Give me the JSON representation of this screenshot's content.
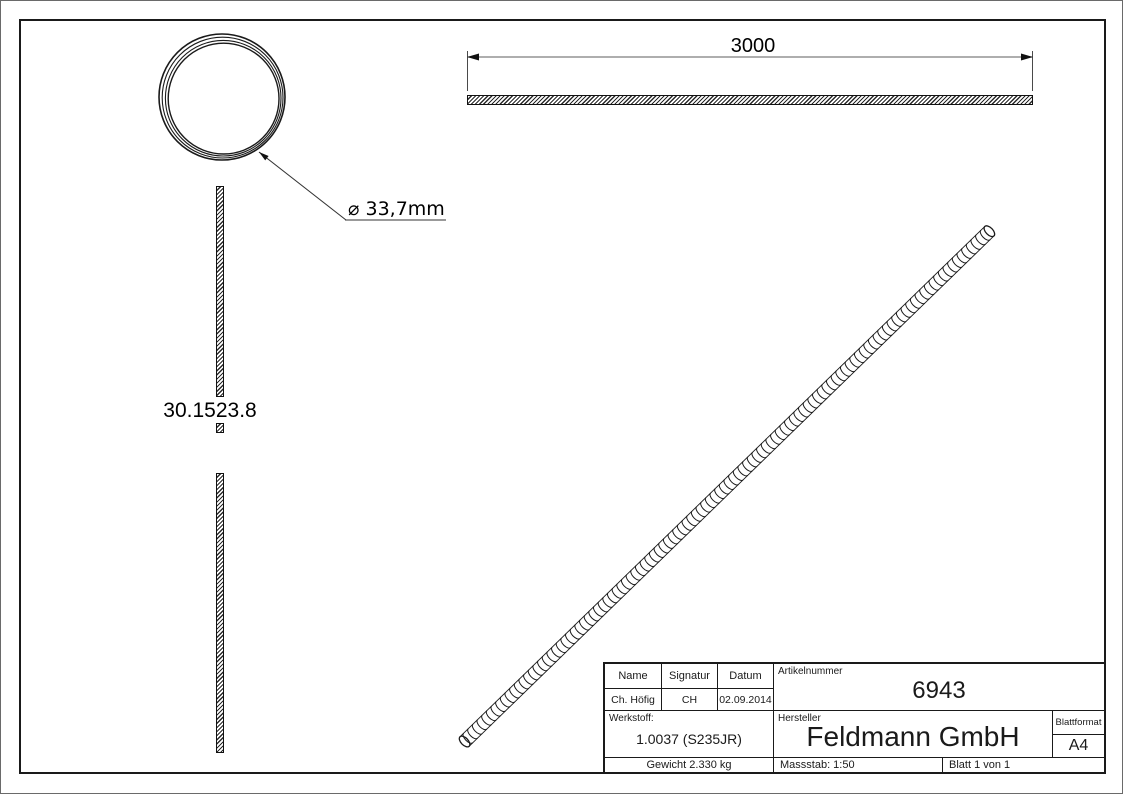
{
  "colors": {
    "line": "#1a1a1a",
    "dimension_line": "#7d7d7d",
    "background": "#ffffff"
  },
  "views": {
    "cross_section": {
      "diameter_label": "⌀ 33,7mm"
    },
    "side_view": {
      "length_label": "3000"
    },
    "front_view": {
      "article_label": "30.1523.8"
    }
  },
  "title_block": {
    "name_header": "Name",
    "signature_header": "Signatur",
    "date_header": "Datum",
    "article_header": "Artikelnummer",
    "name_value": "Ch. Höfig",
    "signature_value": "CH",
    "date_value": "02.09.2014",
    "article_value": "6943",
    "material_label": "Werkstoff:",
    "material_value": "1.0037 (S235JR)",
    "manufacturer_label": "Hersteller",
    "manufacturer_value": "Feldmann GmbH",
    "sheet_format_label": "Blattformat",
    "sheet_format_value": "A4",
    "weight_value": "Gewicht 2.330 kg",
    "scale_value": "Massstab: 1:50",
    "sheet_value": "Blatt 1 von 1"
  }
}
